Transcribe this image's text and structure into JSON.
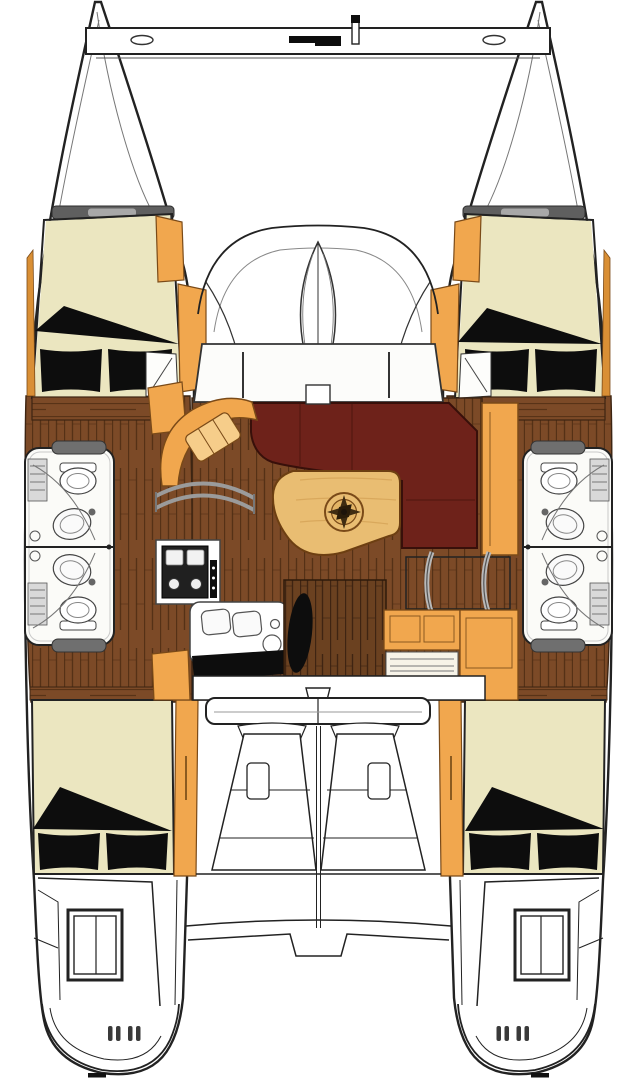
{
  "meta": {
    "type": "floor-plan",
    "view": "top-down"
  },
  "colors": {
    "background": "#ffffff",
    "line": "#222222",
    "hull": "#ffffff",
    "cream": "#ebe6c0",
    "black": "#0d0d0d",
    "orange": "#f1a74e",
    "orangeDark": "#d98f35",
    "floor": "#7c4a27",
    "floorDark": "#4e2c12",
    "doorWood": "#6b4120",
    "table": "#e9bd72",
    "tableStreak": "#d9a85c",
    "settee": "#6e221a",
    "setteeSeam": "#541811",
    "grayTrim": "#9b9b9b",
    "roofBar": "#5f5f5f",
    "counter": "#fbfbf8"
  },
  "regions": [
    "crossbeam",
    "port-bow",
    "starboard-bow",
    "trampoline-area",
    "foredeck",
    "port-forward-cabin",
    "starboard-forward-cabin",
    "port-head",
    "starboard-head",
    "galley",
    "navigation-seat",
    "salon-settee",
    "salon-table",
    "compass-rose",
    "companionway-steps",
    "cockpit",
    "port-aft-cabin",
    "starboard-aft-cabin",
    "port-transom",
    "starboard-transom",
    "swim-platform"
  ]
}
